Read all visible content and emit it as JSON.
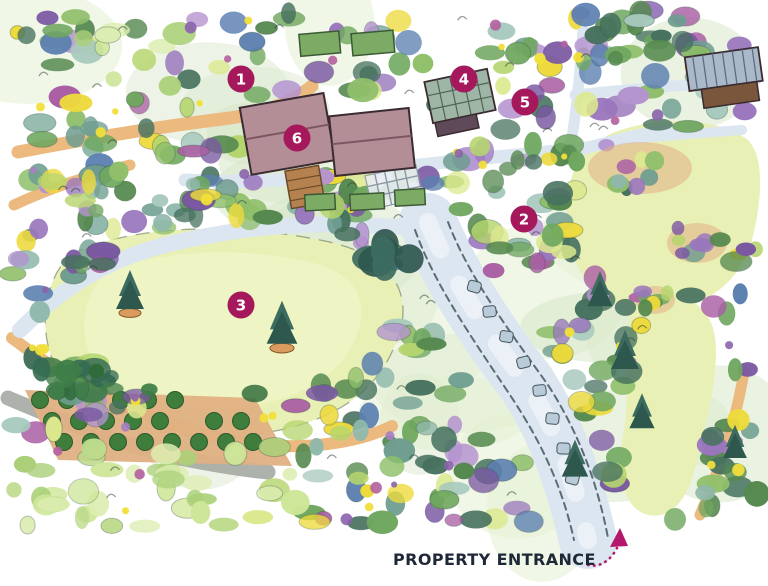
{
  "map": {
    "entrance_label": "PROPERTY ENTRANCE",
    "markers": [
      {
        "id": "1",
        "x": 241,
        "y": 79
      },
      {
        "id": "2",
        "x": 524,
        "y": 219
      },
      {
        "id": "3",
        "x": 241,
        "y": 305
      },
      {
        "id": "4",
        "x": 464,
        "y": 79
      },
      {
        "id": "5",
        "x": 525,
        "y": 102
      },
      {
        "id": "6",
        "x": 297,
        "y": 138
      }
    ]
  },
  "palette": {
    "marker": "#a5195c",
    "marker_text": "#ffffff",
    "label_color": "#1e2836",
    "arrow": "#b4186c",
    "lawn": "#e9f0b5",
    "lawn_inner": "#eef4c3",
    "lawn_edge": "#5a6b52",
    "path_tan": "#ecb97f",
    "path_gray": "#dce6f0",
    "path_highlight": "#f4f8fb",
    "driveway_edge": "#44565e",
    "stone": "#b9cbd9",
    "roof_mauve": "#b48e97",
    "roof_ridge": "#7c5660",
    "building_outline": "#3a2b30",
    "shed_roof": "#a9b9c9",
    "shed_stripe": "#5d6d7d",
    "shed_wall": "#7a573c",
    "greenhouse": "#9fb6a6",
    "greenhouse_grid": "#4f6456",
    "greenhouse_base": "#5f4a5a",
    "deck": "#b5814f",
    "deck_line": "#6b4a28",
    "lattice_bg": "#e8edf1",
    "lattice_line": "#8b98a4",
    "crate": "#cf9257",
    "crate_line": "#8a5a2a",
    "bed_green": "#7cab66",
    "bed_outline": "#3c5a34",
    "orchard_green": "#3f7d3c",
    "orchard_outline": "#2a5a2b",
    "soil": "#e0b083",
    "wall_gray": "#a4aaa3",
    "conifer": "#3d6b60",
    "conifer_dark": "#2e574e",
    "pot": "#d99c5e",
    "squiggle": "#263c2f",
    "yellow_dab": "#f1df3a",
    "foliage": [
      "#55894f",
      "#6fa75f",
      "#8fbf6a",
      "#b5d56e",
      "#47725f",
      "#6e9d90",
      "#8fb8ab",
      "#a7c9bd",
      "#7a58a2",
      "#9a77bd",
      "#b493cf",
      "#aa5fa4",
      "#edda3c",
      "#dce98f",
      "#5b7fb0"
    ],
    "light_bushes": [
      "#bcda8a",
      "#cde698",
      "#abd079",
      "#dcedb0"
    ],
    "dark_hedge": [
      "#2f6b3a",
      "#3f7d49",
      "#356a52"
    ],
    "purple_dabs": [
      "#8a63ac",
      "#a77fc2",
      "#b25f9e"
    ],
    "wash": [
      "#dcead0",
      "#e3efcf",
      "#d5e6c6"
    ]
  }
}
